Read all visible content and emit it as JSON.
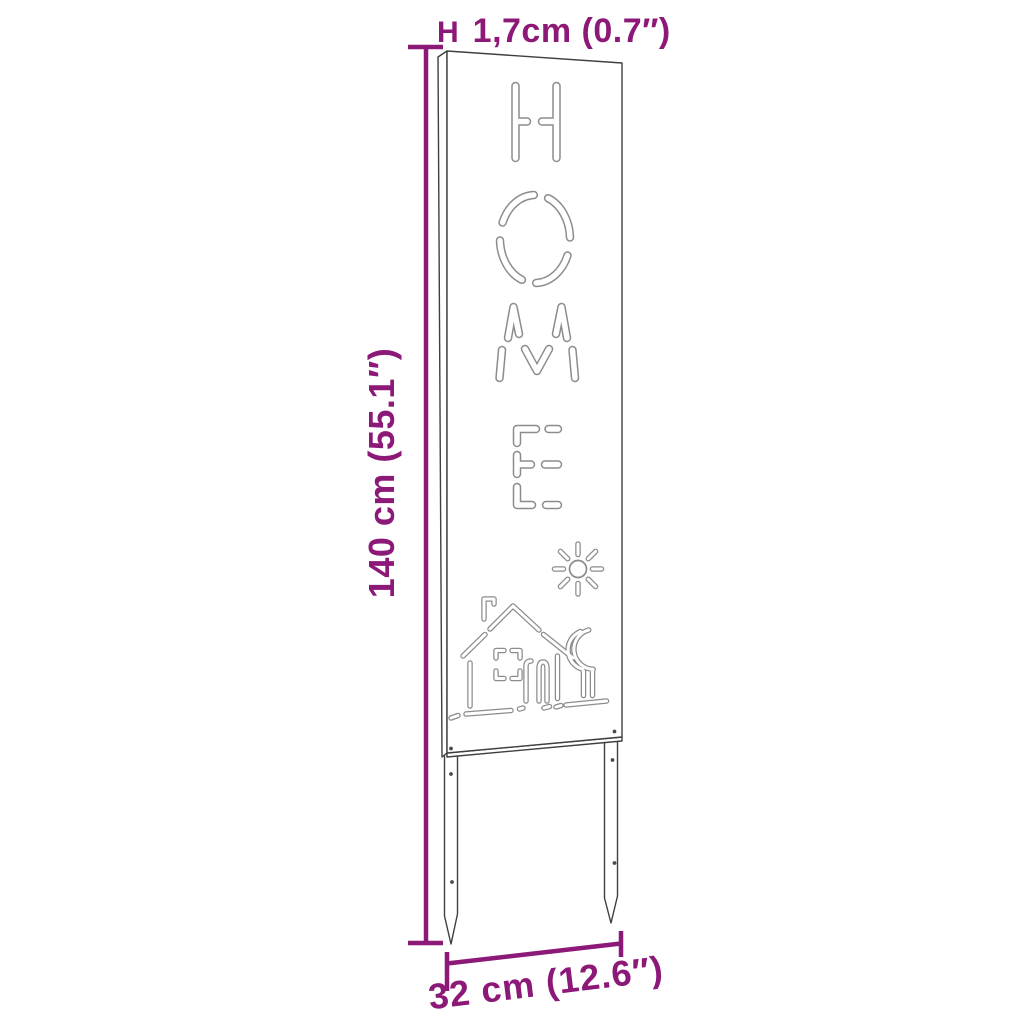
{
  "title": "Garden sign with ground stakes - dimension diagram",
  "cutout_word": "HOME",
  "dimensions": {
    "height": {
      "value": "140 cm (55.1″)"
    },
    "width": {
      "value": "32 cm (12.6″)"
    },
    "thickness": {
      "prefix": "H",
      "value": "1,7cm (0.7″)"
    }
  },
  "colors": {
    "dimension": "#8C1878",
    "panel_outline": "#3f3f3f",
    "cutout_stroke": "#8c8c8c",
    "background": "#ffffff"
  },
  "icons": {
    "sun": "sun-icon",
    "house": "house-icon",
    "tree": "tree-icon"
  }
}
